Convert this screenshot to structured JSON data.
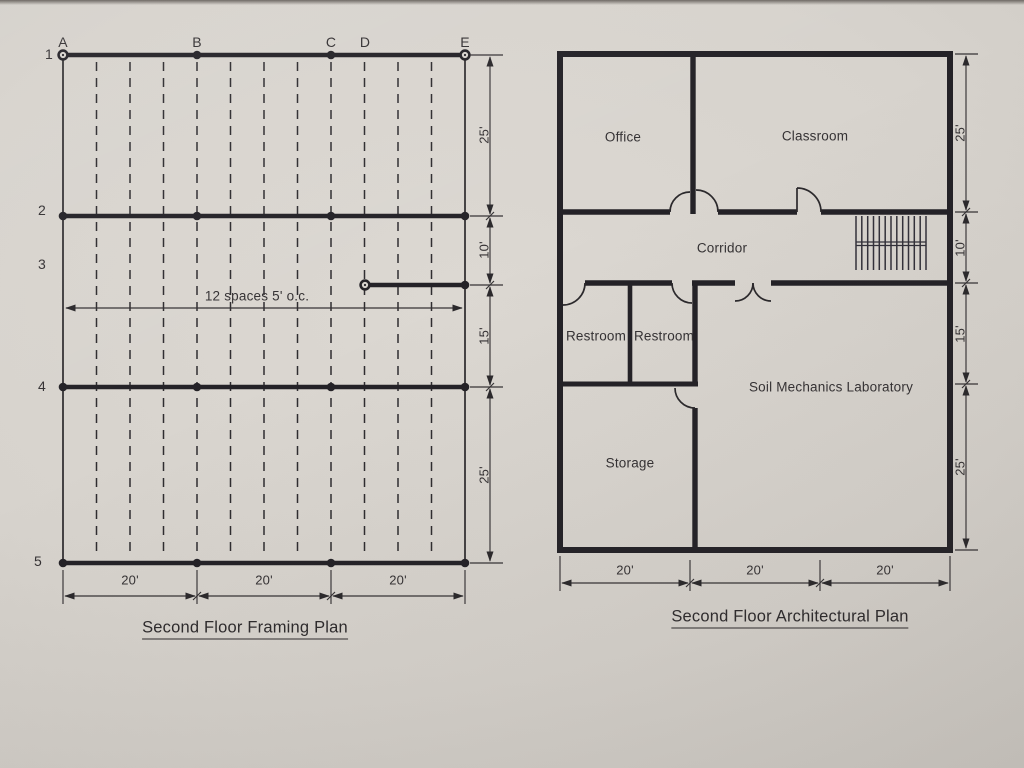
{
  "framing_plan": {
    "title": "Second Floor Framing Plan",
    "columns": [
      "A",
      "B",
      "C",
      "D",
      "E"
    ],
    "rows": [
      "1",
      "2",
      "3",
      "4",
      "5"
    ],
    "joist_note": "12 spaces 5' o.c.",
    "right_dims": [
      "25'",
      "10'",
      "15'",
      "25'"
    ],
    "bottom_dims": [
      "20'",
      "20'",
      "20'"
    ]
  },
  "architectural_plan": {
    "title": "Second Floor Architectural Plan",
    "rooms": {
      "office": "Office",
      "classroom": "Classroom",
      "corridor": "Corridor",
      "restroom_left": "Restroom",
      "restroom_right": "Restroom",
      "lab": "Soil Mechanics Laboratory",
      "storage": "Storage"
    },
    "right_dims": [
      "25'",
      "10'",
      "15'",
      "25'"
    ],
    "bottom_dims": [
      "20'",
      "20'",
      "20'"
    ]
  },
  "colors": {
    "ink": "#2b292c",
    "paper": "#d7d3cd"
  }
}
